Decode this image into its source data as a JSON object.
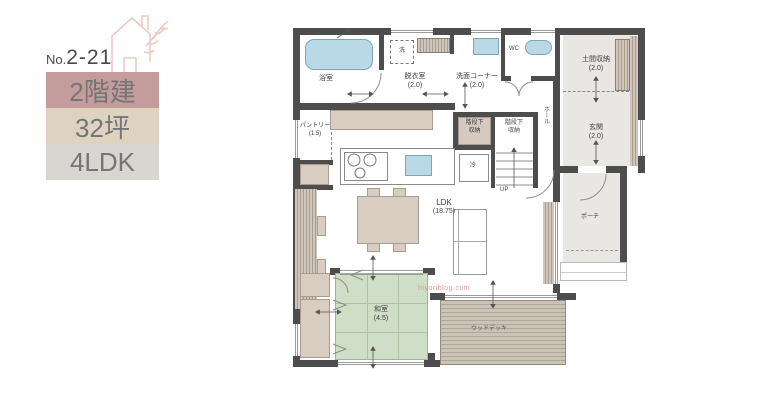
{
  "panel": {
    "number_prefix": "No.",
    "number": "2-21",
    "badges": [
      {
        "label": "2階建",
        "bg": "#c59c9c"
      },
      {
        "label": "32坪",
        "bg": "#ded3c1"
      },
      {
        "label": "4LDK",
        "bg": "#d9d5d1"
      }
    ]
  },
  "floorplan": {
    "watermark": "hiyoriblog.com",
    "rooms": {
      "bath": {
        "name": "浴室"
      },
      "dressing": {
        "name": "脱衣室",
        "size": "(2.0)"
      },
      "wash_corner": {
        "name": "洗面コーナー",
        "size": "(2.0)"
      },
      "wc": {
        "name": "WC"
      },
      "doma_storage": {
        "name": "土間収納",
        "size": "(2.0)"
      },
      "genkan": {
        "name": "玄関",
        "size": "(2.0)"
      },
      "hall": {
        "name": "ホール"
      },
      "stair_storage_left": {
        "line1": "階段下",
        "line2": "収納"
      },
      "stair_storage_right": {
        "line1": "階段下",
        "line2": "収納"
      },
      "pantry": {
        "name": "パントリー",
        "size": "(1.5)"
      },
      "ldk": {
        "name": "LDK",
        "size": "(18.75)"
      },
      "washitsu": {
        "name": "和室",
        "size": "(4.5)"
      },
      "wood_deck": {
        "name": "ウッドデッキ"
      },
      "porch": {
        "name": "ポーチ"
      }
    },
    "fixtures": {
      "washer": "洗",
      "fridge": "冷",
      "stairs_up": "UP"
    },
    "colors": {
      "wall": "#4d4d4d",
      "water_fixture": "#b9d9e7",
      "tatami_green": "#cfdec6",
      "wood_beige": "#d9cdc1",
      "deck": "#c9c0b5",
      "room_gray": "#e9e7e3",
      "watermark_pink": "#de9b9b"
    }
  }
}
